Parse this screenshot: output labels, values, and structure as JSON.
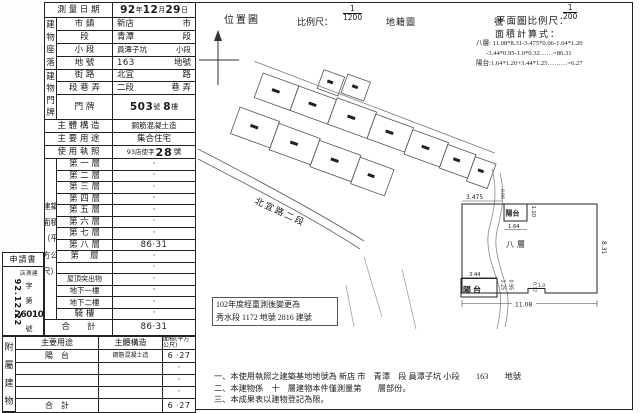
{
  "sheet": {
    "survey_row": {
      "label": "測 量 日 期",
      "y": "92",
      "yu": "年",
      "m": "12",
      "mu": "月",
      "d": "29",
      "du": "日"
    },
    "loc_group": "建物座落",
    "door_group": "建物門牌",
    "loc_rows": [
      {
        "label": "市 鎮",
        "v": "新店",
        "u": "市"
      },
      {
        "label": "段",
        "v": "青潭",
        "u": "段"
      },
      {
        "label": "小 段",
        "v": "員潭子坑",
        "u": "小段"
      },
      {
        "label": "地 號",
        "v": "163",
        "u": "地號"
      },
      {
        "label": "街 路",
        "v": "北宜",
        "u": "路"
      },
      {
        "label": "段 巷 弄",
        "v": "二段",
        "u": "巷 弄"
      }
    ],
    "door_row": {
      "label": "門 牌",
      "n1": "503",
      "u1": "號",
      "n2": "8",
      "u2": "樓"
    },
    "structure_row": {
      "label": "主 體 構 造",
      "v": "鋼筋混凝土造"
    },
    "use_row": {
      "label": "主 要 用 途",
      "v": "集合住宅"
    },
    "license_row": {
      "label": "使 用 執 照",
      "prefix": "93店使字",
      "num": "28",
      "suffix": "號"
    },
    "area_side": "建築面積（平方公尺）",
    "area_rows": [
      {
        "label": "第 一 層",
        "v": "·"
      },
      {
        "label": "第 二 層",
        "v": "·"
      },
      {
        "label": "第 三 層",
        "v": "·"
      },
      {
        "label": "第 四 層",
        "v": "·"
      },
      {
        "label": "第 五 層",
        "v": "·"
      },
      {
        "label": "第 六 層",
        "v": "·"
      },
      {
        "label": "第 七 層",
        "v": "·"
      },
      {
        "label": "第 八 層",
        "v": "86·31"
      },
      {
        "label": "第　 層",
        "v": "·"
      },
      {
        "label": "",
        "v": "·"
      },
      {
        "label": "屋頂突出物",
        "v": "·"
      },
      {
        "label": "地下一樓",
        "v": "·"
      },
      {
        "label": "地下二樓",
        "v": "·"
      },
      {
        "label": "騎 樓",
        "v": "·"
      }
    ],
    "area_total": {
      "label": "合　　計",
      "v": "86·31"
    },
    "application": {
      "title": "申請書",
      "date": "92.12.22",
      "office": "店測建",
      "zi": "字",
      "di": "第",
      "num": "26010",
      "hao": "號"
    },
    "attached": {
      "side": "附屬建物",
      "headers": [
        "主要用途",
        "主體構造",
        "面積(平方公尺)"
      ],
      "rows": [
        {
          "use": "陽　台",
          "structure": "鋼筋混凝土造",
          "area": "6 ·27"
        },
        {
          "use": "",
          "structure": "",
          "area": "·"
        },
        {
          "use": "",
          "structure": "",
          "area": "·"
        },
        {
          "use": "",
          "structure": "",
          "area": "·"
        }
      ],
      "total": {
        "use": "合　計",
        "area": "6 ·27"
      }
    }
  },
  "map": {
    "title": "位置圖",
    "scale_label": "比例尺：",
    "scale_num": "1",
    "scale_den": "1200",
    "type_label": "地籍圖",
    "sheet_label": "號",
    "road": "北宜路二段"
  },
  "plan": {
    "scale_label": "平面圖比例尺：",
    "scale_num": "1",
    "scale_den": "200",
    "calc_title": "面積計算式：",
    "calc_lines": [
      "八層: 11.08*8.31-3.475*0.06-1.64*1.20",
      "-3.44*0.95-1.0*0.32……=86.31",
      "陽台:1.64*1.20+3.44*1.25………=6.27"
    ],
    "room": "八層",
    "balcony": "陽台",
    "dims": {
      "top": "3.475",
      "notch": "0.06",
      "bal_top_w": "1.64",
      "bal_top_d": "1.20",
      "bal_bot_w": "3.44",
      "bal_bot_d": "1.25",
      "inset": "0.95",
      "step_d": "0.32",
      "step_w": "1.0",
      "bottom": "11.08",
      "right": "8.31"
    }
  },
  "remark": {
    "line1": "102年度經重測後變更為",
    "line2": "秀水段 1172 地號 2816 建號"
  },
  "notes": [
    "一、本使用執照之建築基地地號為 新店 市　青潭　段 員潭子坑 小段　　163　　地號",
    "二、本建物係　十　層建物本件僅測量第　　層部份。",
    "三、本成果表以建物登記為限。"
  ],
  "ink": "#1a1a1a"
}
